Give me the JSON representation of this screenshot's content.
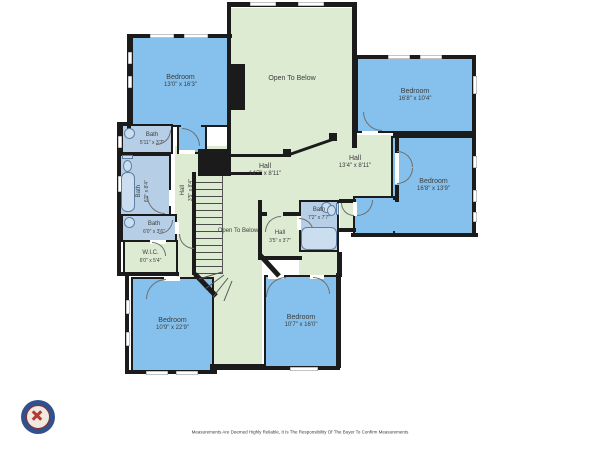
{
  "plan": {
    "type": "second-floor residential floor plan",
    "colors": {
      "bedroom_fill": "#85c1ec",
      "bath_fill": "#b7cfe6",
      "hall_fill": "#dcebd2",
      "wall": "#1b1b1b",
      "background": "#ffffff"
    },
    "rooms": {
      "bedroom_tl": {
        "name": "Bedroom",
        "dims": "13'0\" x 16'3\""
      },
      "bedroom_tr": {
        "name": "Bedroom",
        "dims": "16'8\" x 10'4\""
      },
      "bedroom_right": {
        "name": "Bedroom",
        "dims": "16'8\" x 13'9\""
      },
      "bedroom_bl": {
        "name": "Bedroom",
        "dims": "10'9\" x 22'9\""
      },
      "bedroom_br": {
        "name": "Bedroom",
        "dims": "10'7\" x 16'0\""
      },
      "bath_upper": {
        "name": "Bath",
        "dims": "5'11\" x 3'7\""
      },
      "bath_mid": {
        "name": "Bath",
        "dims": "6'0\" x 8'4\""
      },
      "bath_lower": {
        "name": "Bath",
        "dims": "6'0\" x 3'6\""
      },
      "bath_center": {
        "name": "Bath",
        "dims": "7'2\" x 7'7\""
      },
      "wic": {
        "name": "W.I.C.",
        "dims": "6'0\" x 5'4\""
      },
      "hall_vert": {
        "name": "Hall",
        "dims": "3'5\" x 8'4\""
      },
      "hall_main": {
        "name": "Hall",
        "dims": "14'7\" x 8'11\""
      },
      "hall_right": {
        "name": "Hall",
        "dims": "13'4\" x 8'11\""
      },
      "hall_small": {
        "name": "Hall",
        "dims": "3'5\" x 3'7\""
      },
      "open_top": {
        "name": "Open To Below"
      },
      "open_bottom": {
        "name": "Open To Below"
      }
    },
    "disclaimer": "Measurements Are Deemed Highly Reliable, It Is The Responsibility Of The Buyer To Confirm Measurements",
    "logo": "circular-compass-seal"
  }
}
